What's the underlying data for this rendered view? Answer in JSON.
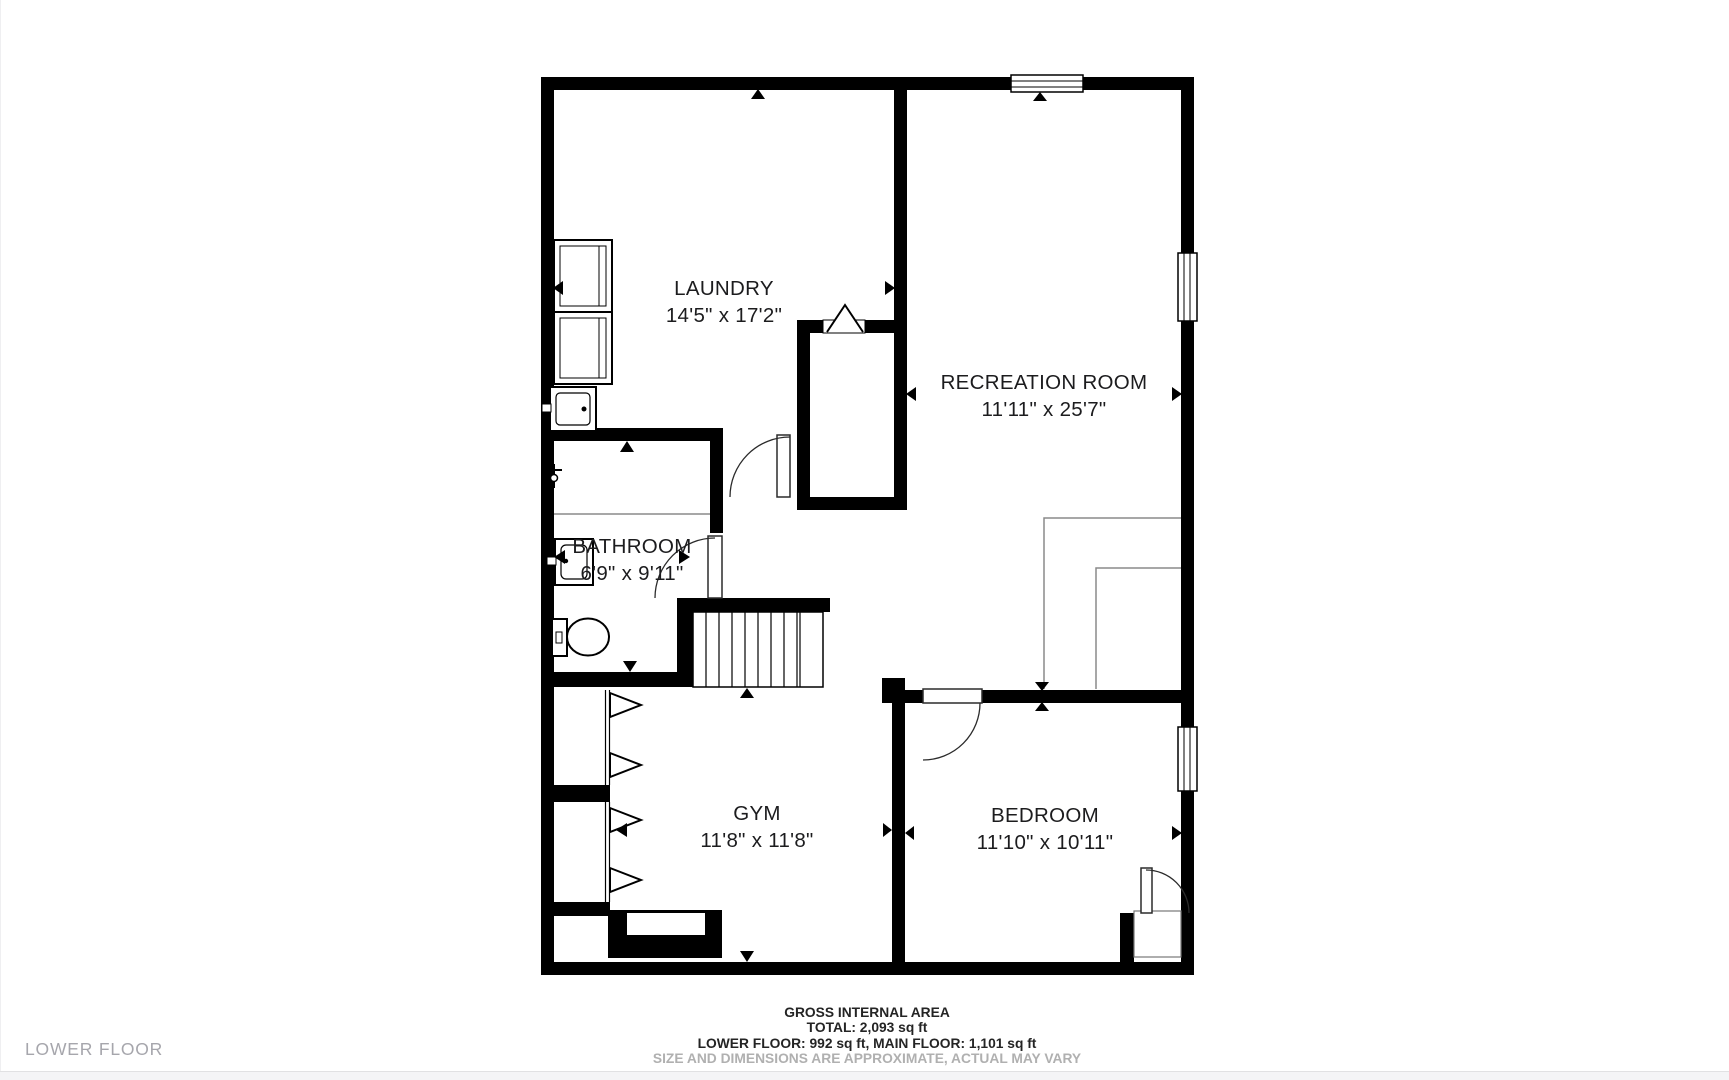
{
  "page": {
    "floor_label": "LOWER FLOOR"
  },
  "floorplan": {
    "rooms": [
      {
        "name": "LAUNDRY",
        "dims": "14'5\" x 17'2\""
      },
      {
        "name": "RECREATION ROOM",
        "dims": "11'11\" x 25'7\""
      },
      {
        "name": "BATHROOM",
        "dims": "6'9\" x 9'11\""
      },
      {
        "name": "GYM",
        "dims": "11'8\" x 11'8\""
      },
      {
        "name": "BEDROOM",
        "dims": "11'10\" x 10'11\""
      }
    ],
    "fixture_icons": [
      "washer-icon",
      "dryer-icon",
      "laundry-sink-icon",
      "shower-icon",
      "bathroom-sink-icon",
      "toilet-icon",
      "stairs-icon",
      "window-icon",
      "door-icon",
      "bifold-door-icon",
      "fireplace-icon"
    ],
    "wall_color": "#000000"
  },
  "footer": {
    "title": "GROSS INTERNAL AREA",
    "total": "TOTAL: 2,093 sq ft",
    "floors": "LOWER FLOOR: 992 sq ft, MAIN FLOOR: 1,101 sq ft",
    "disclaimer": "SIZE AND DIMENSIONS ARE APPROXIMATE, ACTUAL MAY VARY"
  },
  "colors": {
    "text": "#1c1c1e",
    "muted_label": "#a6a6ac",
    "disclaimer": "#b0b0b0"
  }
}
